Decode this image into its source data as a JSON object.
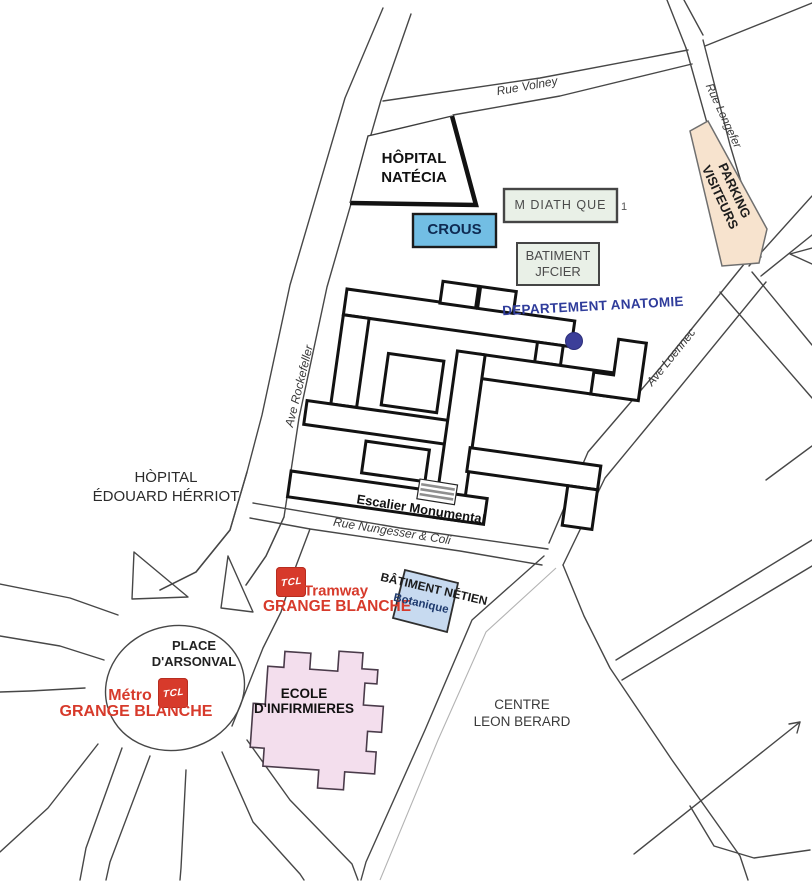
{
  "streets": {
    "rue_volney": "Rue Volney",
    "rue_longefer": "Rue Longefer",
    "ave_rockefeller": "Ave Rockefeller",
    "ave_loennec": "Ave Loennec",
    "rue_nungesser": "Rue Nungesser & Coli",
    "escalier_monumental": "Escalier Monumental"
  },
  "places": {
    "hopital_natecia_l1": "HÔPITAL",
    "hopital_natecia_l2": "NATÉCIA",
    "crous": "CROUS",
    "mediatheque": "M DIATH QUE",
    "mediatheque_note": "1",
    "batiment_jfcier_l1": "BATIMENT",
    "batiment_jfcier_l2": "JFCIER",
    "parking_l1": "PARKING",
    "parking_l2": "VISITEURS",
    "departement_anatomie": "DEPARTEMENT ANATOMIE",
    "heh_l1": "HÒPITAL",
    "heh_l2": "ÉDOUARD HÉRRIOT",
    "tramway": "Tramway",
    "tramway_grange_blanche": "GRANGE BLANCHE",
    "batiment_netien": "BÂTIMENT NÉTIEN",
    "botanique": "Botanique",
    "place_arsonval_l1": "PLACE",
    "place_arsonval_l2": "D'ARSONVAL",
    "metro": "Métro",
    "metro_grange_blanche": "GRANGE BLANCHE",
    "ecole_l1": "ECOLE",
    "ecole_l2": "D'INFIRMIERES",
    "centre_leon_berard_l1": "CENTRE",
    "centre_leon_berard_l2": "LEON BERARD"
  },
  "icons": {
    "tcl_logo_text": "TCL"
  },
  "colors": {
    "tcl_red": "#D73A2B",
    "crous_blue": "#72BEE4",
    "info_box_green": "#E9F0E7",
    "parking_tan": "#F7E3CE",
    "netien_blue": "#C7DAF0",
    "ecole_pink": "#F3DEED",
    "anatomie_blue": "#2F3C9B",
    "road_gray": "#474747"
  }
}
